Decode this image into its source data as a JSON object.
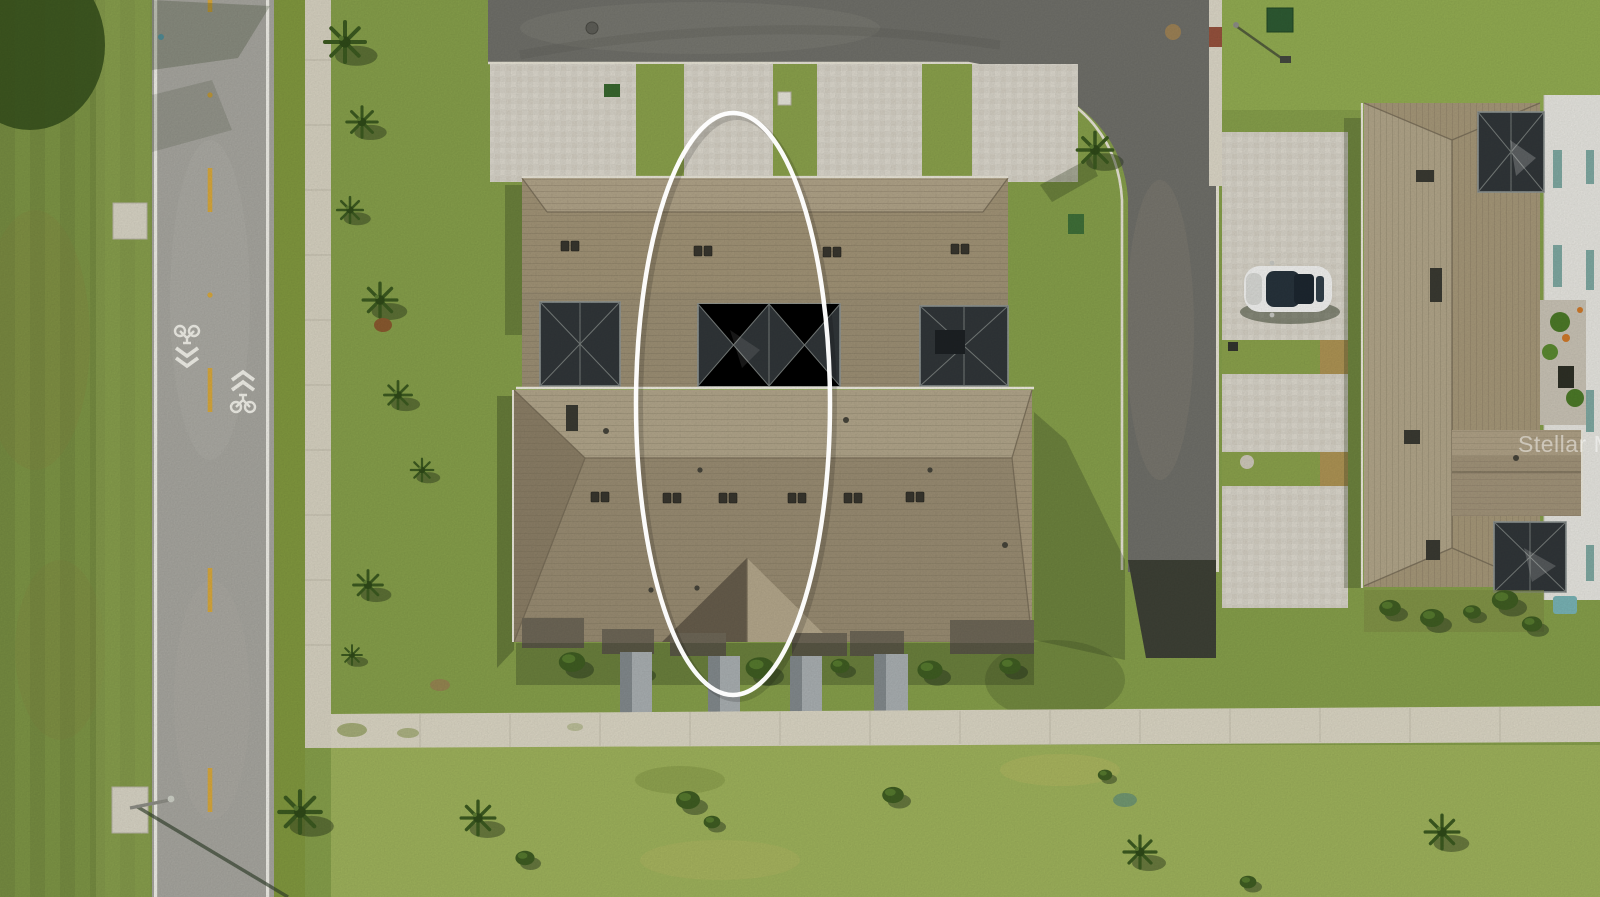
{
  "photo": {
    "kind": "aerial-drone-photo",
    "watermark_text": "Stellar MLS",
    "annotation_color": "#ffffff"
  },
  "colors": {
    "lawn_base": "#87a04b",
    "lawn_light": "#9fb35c",
    "lawn_dark": "#6f8c3c",
    "road_left_asphalt": "#a8a7a0",
    "road_top_asphalt": "#70706a",
    "fresh_asphalt_patch": "#3e4136",
    "concrete_sidewalk": "#dcd7c5",
    "paver_driveway": "#d8d4c9",
    "roof_shingle_light": "#b2a68b",
    "roof_shingle_mid": "#a2947a",
    "roof_shingle_dark": "#8c7f67",
    "screen_enclosure": "#313639",
    "wall_white": "#e8e7e1",
    "car_white": "#f3f3f1",
    "lane_line_yellow": "#d9a93c",
    "road_marking_white": "#f2f1ea",
    "ellipse_stroke": "#ffffff"
  }
}
